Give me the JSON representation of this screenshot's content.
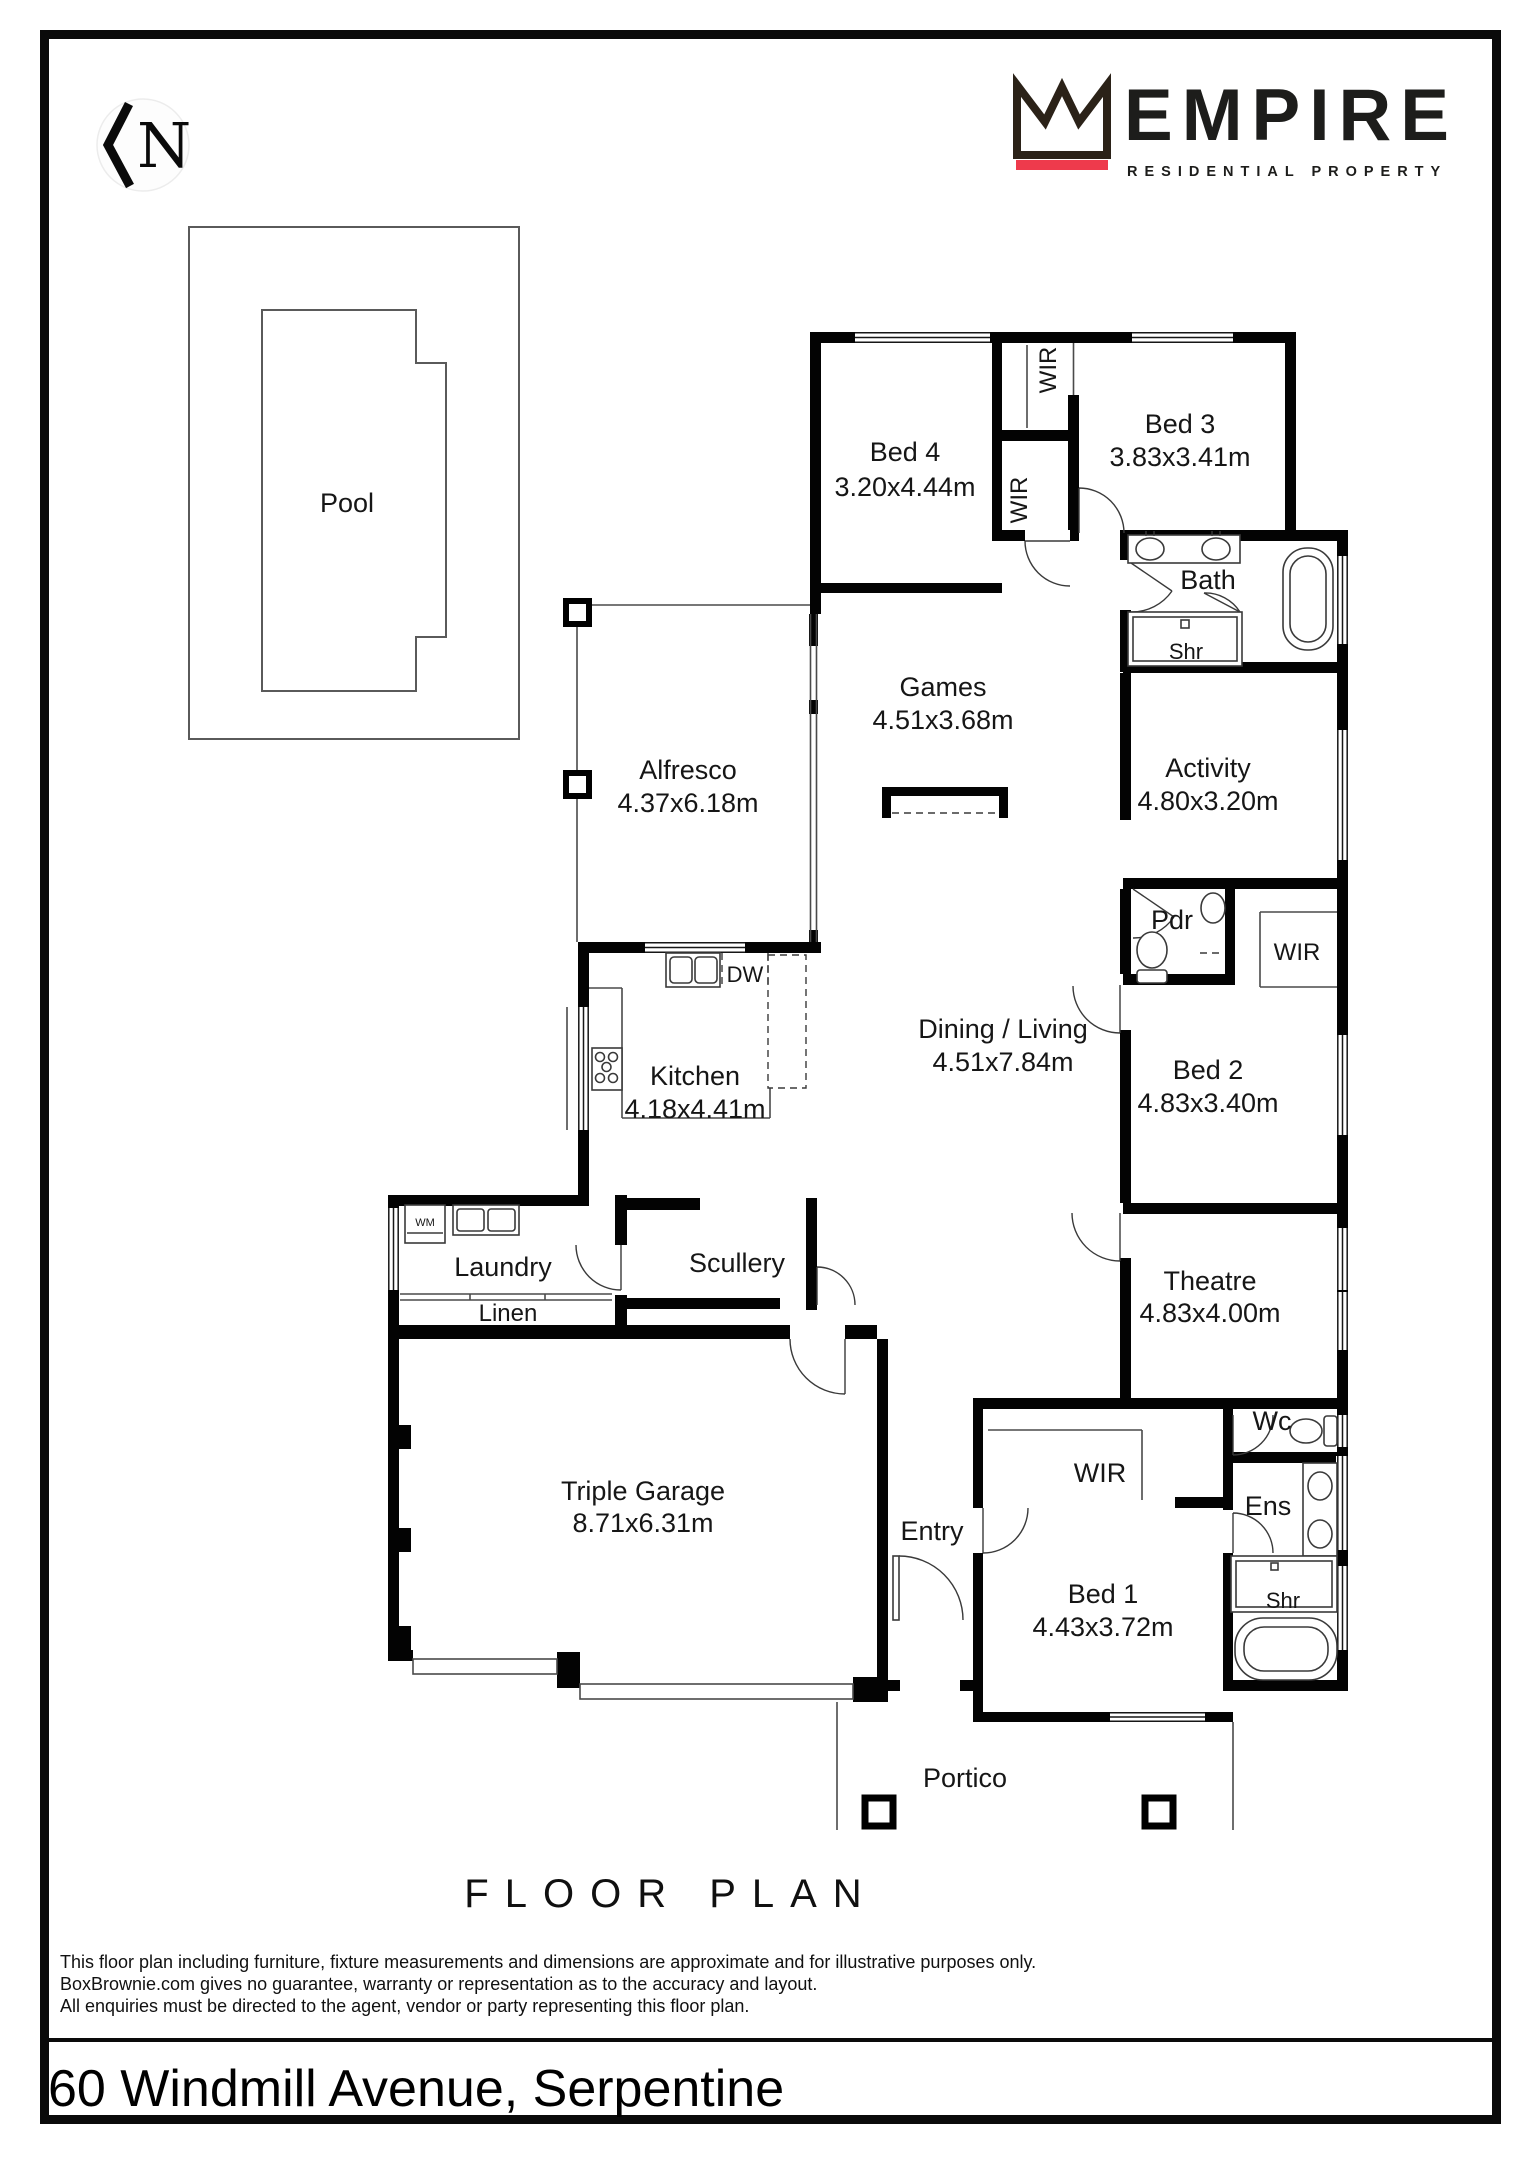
{
  "page": {
    "plan_title": "FLOOR PLAN",
    "address": "60 Windmill Avenue, Serpentine",
    "disclaimer": [
      "This floor plan including furniture, fixture measurements and dimensions are approximate and for illustrative purposes only.",
      "BoxBrownie.com gives no guarantee, warranty or representation as to the accuracy and layout.",
      "All enquiries must be directed to the agent, vendor or party representing this floor plan."
    ]
  },
  "branding": {
    "company": "EMPIRE",
    "tagline": "RESIDENTIAL PROPERTY",
    "north_label": "N",
    "accent_red": "#ee3a4c",
    "crown_color": "#2b2218"
  },
  "rooms": {
    "pool": {
      "name": "Pool"
    },
    "bed4": {
      "name": "Bed 4",
      "dims": "3.20x4.44m"
    },
    "bed3": {
      "name": "Bed 3",
      "dims": "3.83x3.41m"
    },
    "bath": {
      "name": "Bath"
    },
    "games": {
      "name": "Games",
      "dims": "4.51x3.68m"
    },
    "activity": {
      "name": "Activity",
      "dims": "4.80x3.20m"
    },
    "alfresco": {
      "name": "Alfresco",
      "dims": "4.37x6.18m"
    },
    "pdr": {
      "name": "Pdr"
    },
    "dining": {
      "name": "Dining / Living",
      "dims": "4.51x7.84m"
    },
    "kitchen": {
      "name": "Kitchen",
      "dims": "4.18x4.41m"
    },
    "bed2": {
      "name": "Bed 2",
      "dims": "4.83x3.40m"
    },
    "laundry": {
      "name": "Laundry"
    },
    "scullery": {
      "name": "Scullery"
    },
    "linen": {
      "name": "Linen"
    },
    "theatre": {
      "name": "Theatre",
      "dims": "4.83x4.00m"
    },
    "garage": {
      "name": "Triple Garage",
      "dims": "8.71x6.31m"
    },
    "entry": {
      "name": "Entry"
    },
    "wc": {
      "name": "Wc"
    },
    "ens": {
      "name": "Ens"
    },
    "bed1": {
      "name": "Bed 1",
      "dims": "4.43x3.72m"
    },
    "portico": {
      "name": "Portico"
    }
  },
  "closets": {
    "wir_top": {
      "name": "WIR"
    },
    "wir_mid": {
      "name": "WIR"
    },
    "wir_bed2": {
      "name": "WIR"
    },
    "wir_bed1": {
      "name": "WIR"
    }
  },
  "fixtures": {
    "dishwasher": "DW",
    "washing_machine": "WM",
    "shower_bath": "Shr",
    "shower_ens": "Shr"
  }
}
